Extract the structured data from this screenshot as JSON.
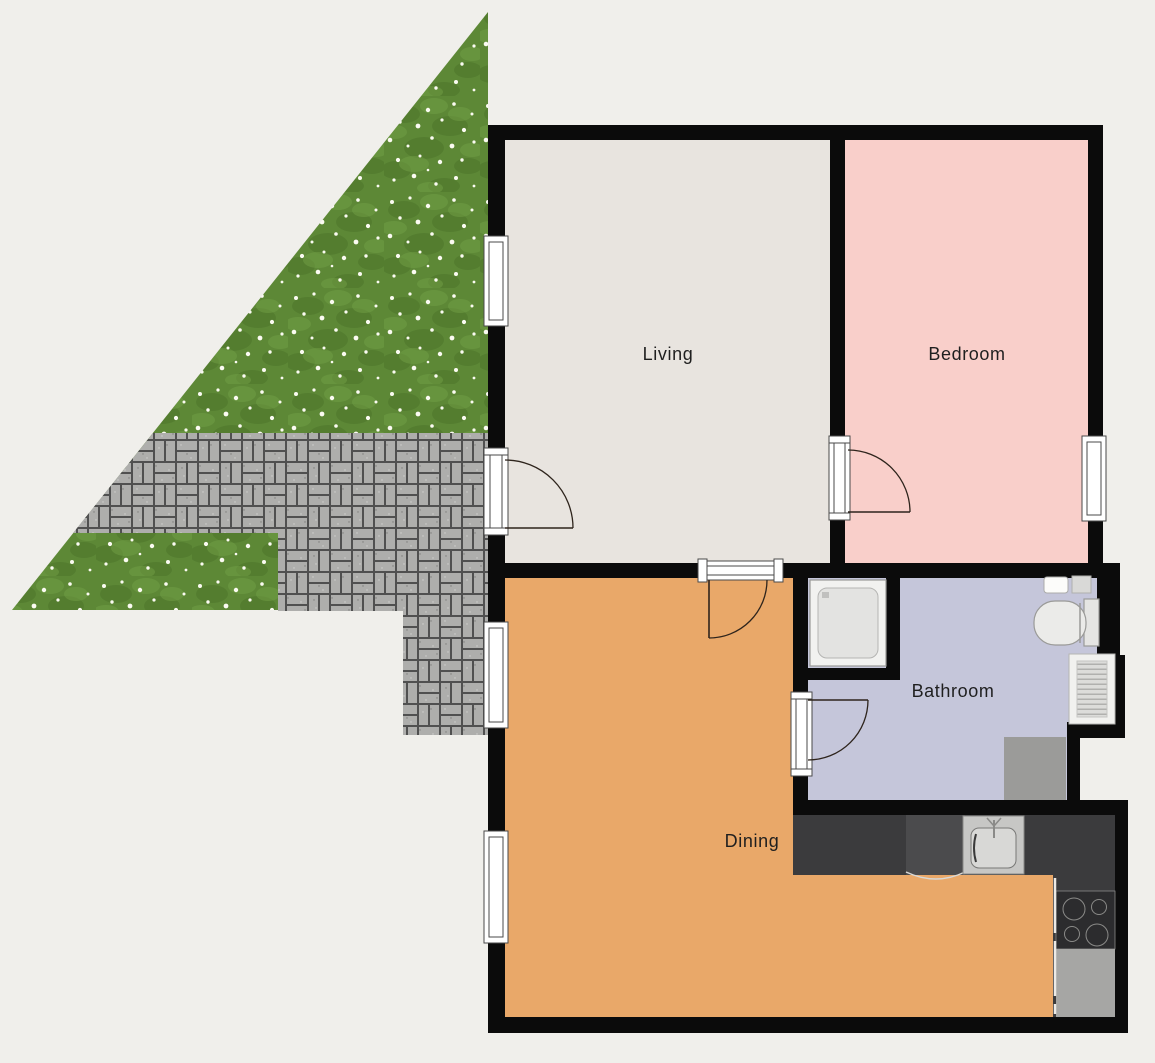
{
  "title": "Apartment floor plan with garden",
  "background": "#f0efeb",
  "walls": {
    "color": "#0b0b0b"
  },
  "label_style": {
    "color": "#1f1f1f"
  },
  "rooms": [
    {
      "name": "living",
      "label": "Living",
      "floor_color": "#e8e4df"
    },
    {
      "name": "bedroom",
      "label": "Bedroom",
      "floor_color": "#f9cfca"
    },
    {
      "name": "bathroom",
      "label": "Bathroom",
      "floor_color": "#c5c6da"
    },
    {
      "name": "dining",
      "label": "Dining",
      "floor_color": "#e9a869"
    }
  ],
  "outdoor": {
    "grass_color": "#5d8836",
    "grass_dark_patch_color": "#4b742a",
    "grass_light_patch_color": "#72a046",
    "flower_color": "#fbfbf2",
    "paving_joint_color": "#505050",
    "paving_brick_color": "#aeaeac"
  },
  "kitchen": {
    "counter_color": "#3b3b3d",
    "oven_color": "#4b4b4d",
    "cooktop_color": "#2c2c2e",
    "appliance_color": "#a6a6a4"
  },
  "fixture_icons": [
    "shower-icon",
    "toilet-icon",
    "hand-basin-icon",
    "wall-shelf-icon",
    "radiator-icon",
    "washing-machine-icon",
    "kitchen-counter-icon",
    "kitchen-sink-icon",
    "oven-icon",
    "cooktop-icon",
    "dishwasher-icon"
  ]
}
